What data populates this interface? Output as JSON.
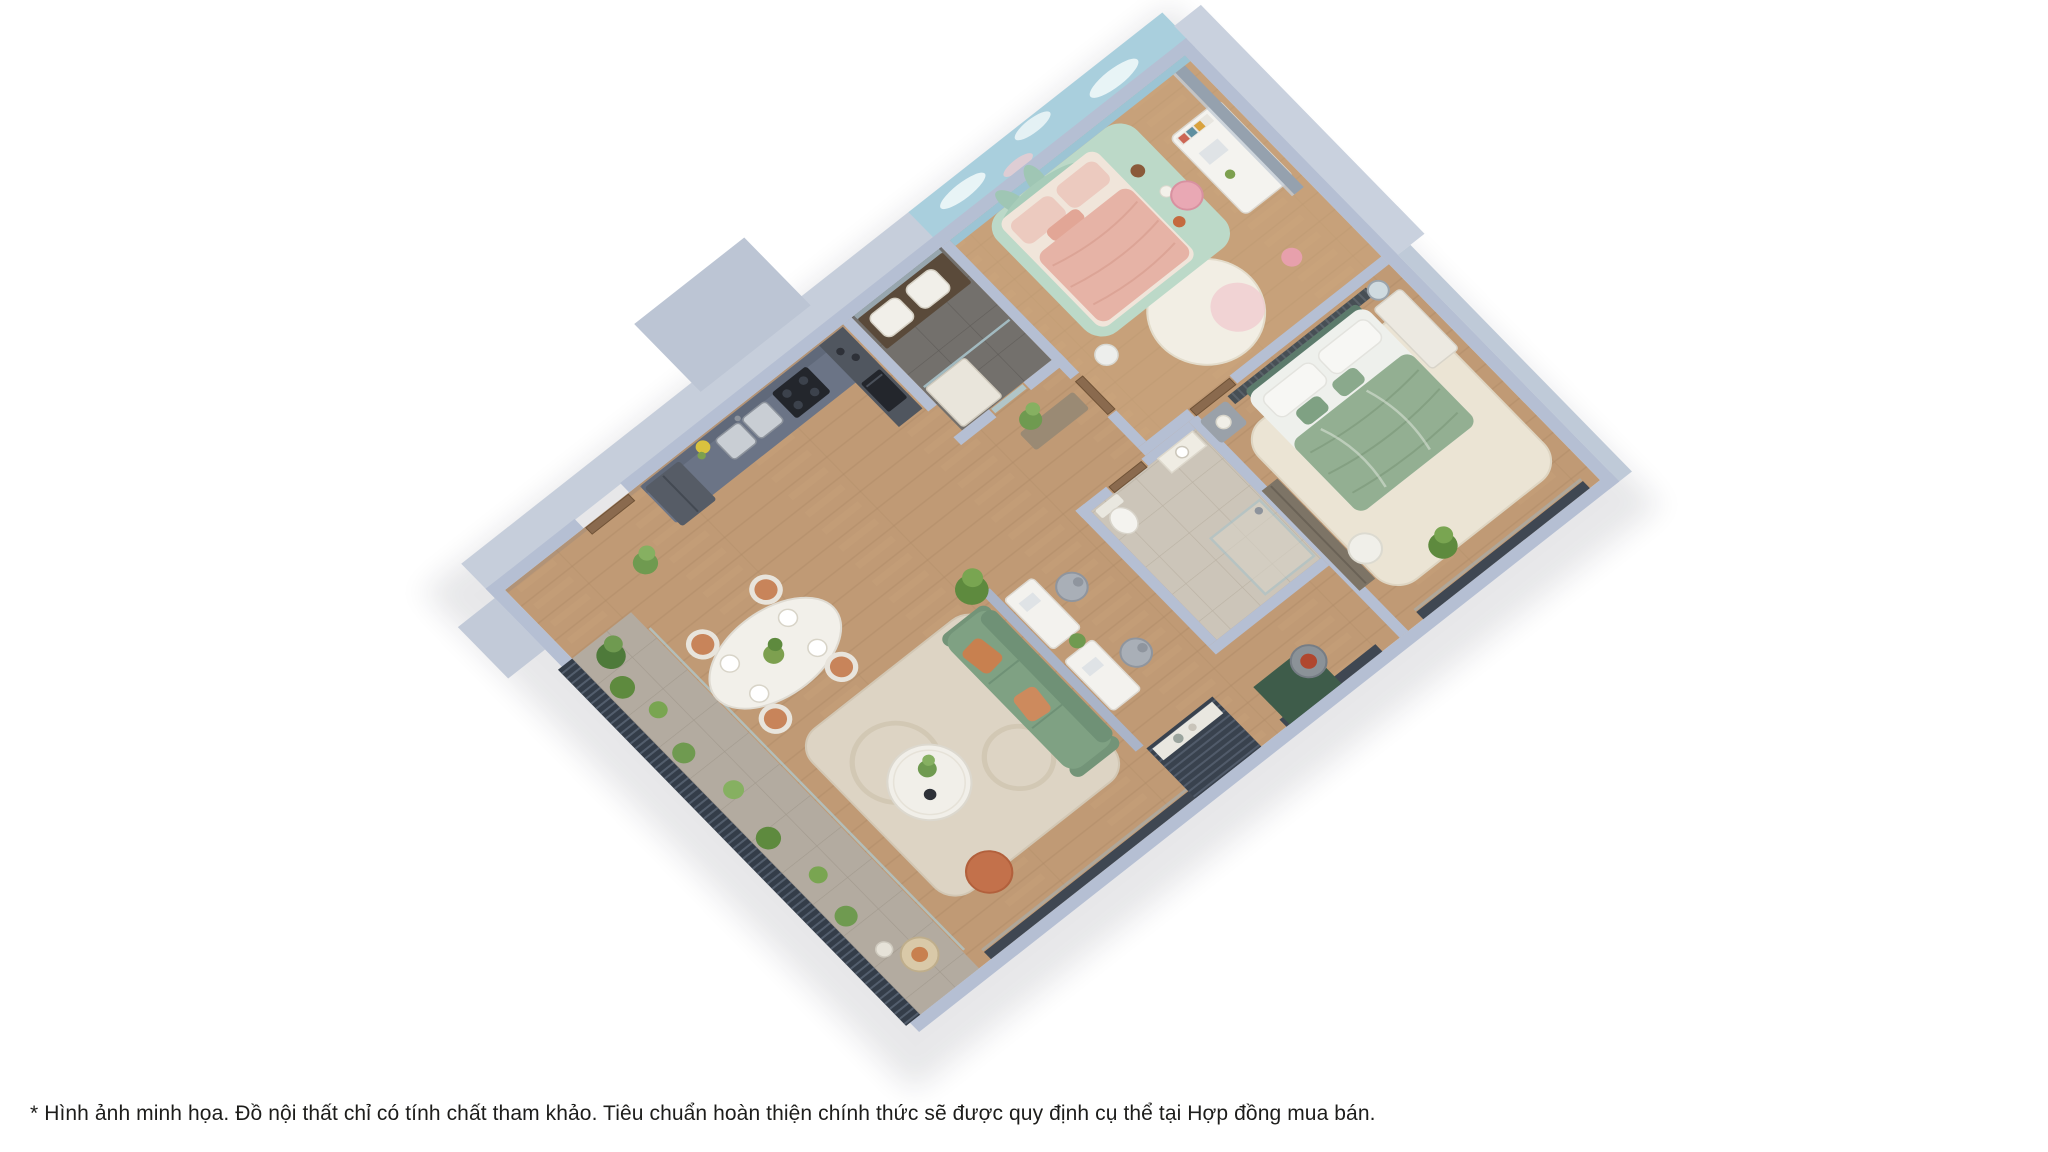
{
  "page": {
    "background_color": "#ffffff",
    "kind": "real-estate apartment 3D floor plan visualization"
  },
  "caption": {
    "text": "* Hình ảnh minh họa. Đồ nội thất chỉ có tính chất tham khảo. Tiêu chuẩn hoàn thiện chính thức sẽ được quy định cụ thể tại Hợp đồng mua bán.",
    "color": "#1d1d1b"
  },
  "illustration": {
    "type": "isometric-3d-apartment-floor-plan-render",
    "rooms": [
      "entry",
      "kitchen",
      "bathroom-1",
      "kids-bedroom",
      "corridor",
      "study-nook",
      "bathroom-2",
      "master-bedroom",
      "living-room",
      "dining-area",
      "balcony"
    ],
    "palette": {
      "walls": "#b5bfd3",
      "wall_tall_faces": "#c6cedb",
      "wood_floor": "#c09a75",
      "kids_mural_sky": "#a9cfdd",
      "kids_bed_pink": "#e6b3a6",
      "kids_headboard_mint": "#a7ccb9",
      "master_bed_green": "#93af92",
      "sofa_green": "#7fa183",
      "accent_terracotta": "#c8804f",
      "bath_dark_tile": "#73706c",
      "bath_beige_tile": "#ccc5b9",
      "rug_cream": "#ddd4c4",
      "railing_dark": "#343d49",
      "window_frame": "#3f4752",
      "plants": "#5e8a3e"
    }
  }
}
